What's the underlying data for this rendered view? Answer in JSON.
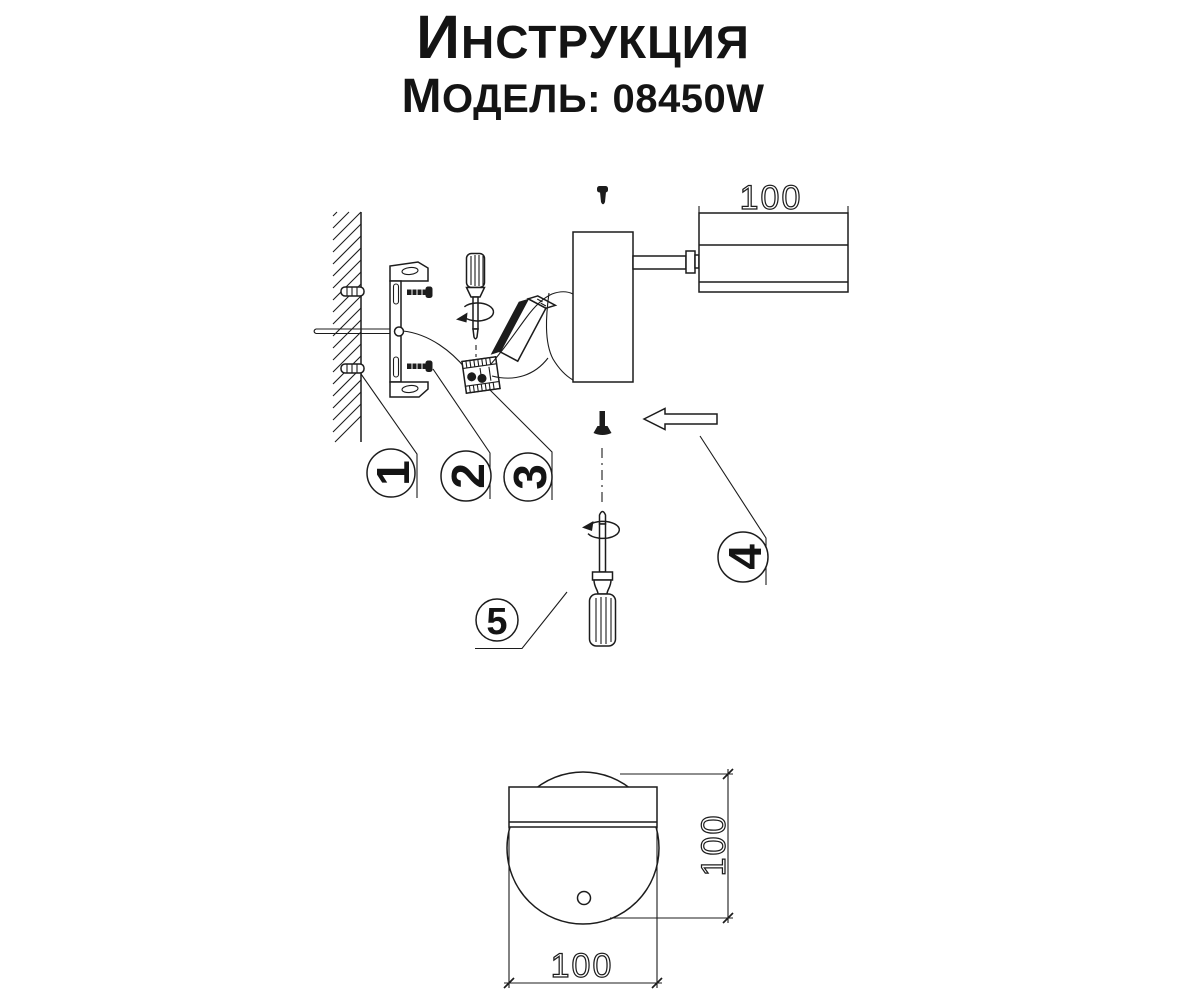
{
  "page": {
    "background": "#ffffff",
    "line_color": "#1c1c1c"
  },
  "header": {
    "title": "Инструкция",
    "model_label": "Модель: 08450W"
  },
  "callouts": [
    "1",
    "2",
    "3",
    "4",
    "5"
  ],
  "dimensions": {
    "head_length": "100",
    "front_height": "100",
    "front_width": "100"
  }
}
